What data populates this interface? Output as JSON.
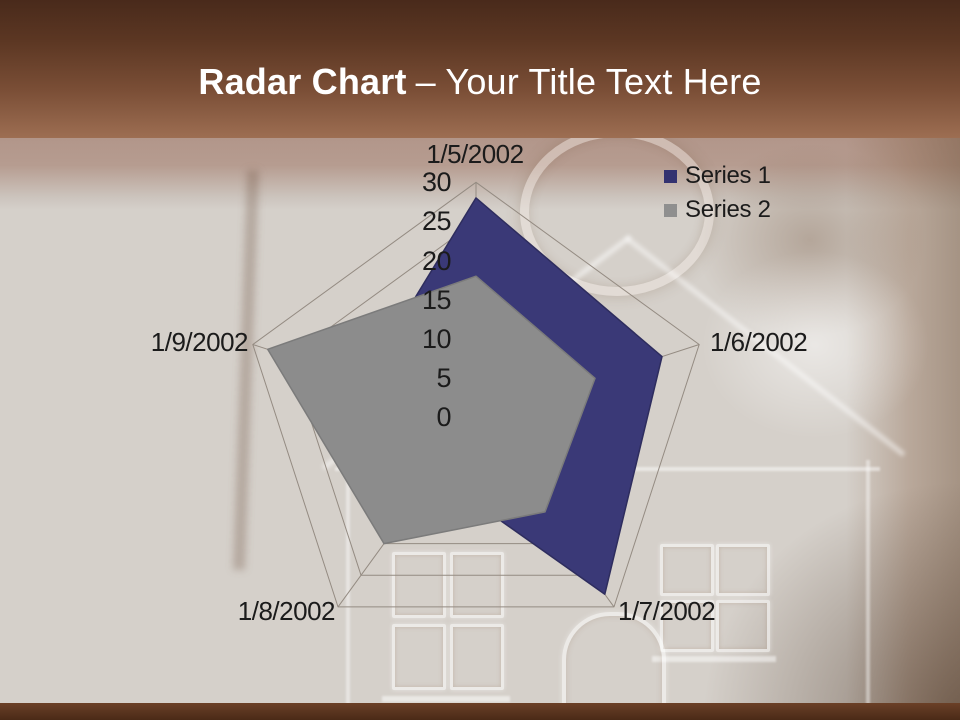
{
  "title": {
    "bold": "Radar Chart",
    "rest": "– Your Title Text Here"
  },
  "chart_data": {
    "type": "radar",
    "categories": [
      "1/5/2002",
      "1/6/2002",
      "1/7/2002",
      "1/8/2002",
      "1/9/2002"
    ],
    "series": [
      {
        "name": "Series 1",
        "values": [
          28,
          25,
          28,
          9,
          15
        ],
        "color": "#3A3977",
        "outline": "#2E2D5E"
      },
      {
        "name": "Series 2",
        "values": [
          18,
          16,
          15,
          20,
          28
        ],
        "color": "#8C8C8C",
        "outline": "#7B7B7B"
      }
    ],
    "axis": {
      "min": 0,
      "max": 30,
      "step": 5,
      "tick_labels": [
        "0",
        "5",
        "10",
        "15",
        "20",
        "25",
        "30"
      ]
    },
    "legend": {
      "position": "top-right",
      "items": [
        {
          "label": "Series 1",
          "color": "#333270"
        },
        {
          "label": "Series 2",
          "color": "#8F8F8F"
        }
      ]
    },
    "grid": true
  },
  "colors": {
    "grid_line": "#948B82",
    "text": "#1B1B1B",
    "header_brown": "#6B4027",
    "footer_brown": "#4A2A17",
    "background_beige": "#D5D0CA"
  }
}
